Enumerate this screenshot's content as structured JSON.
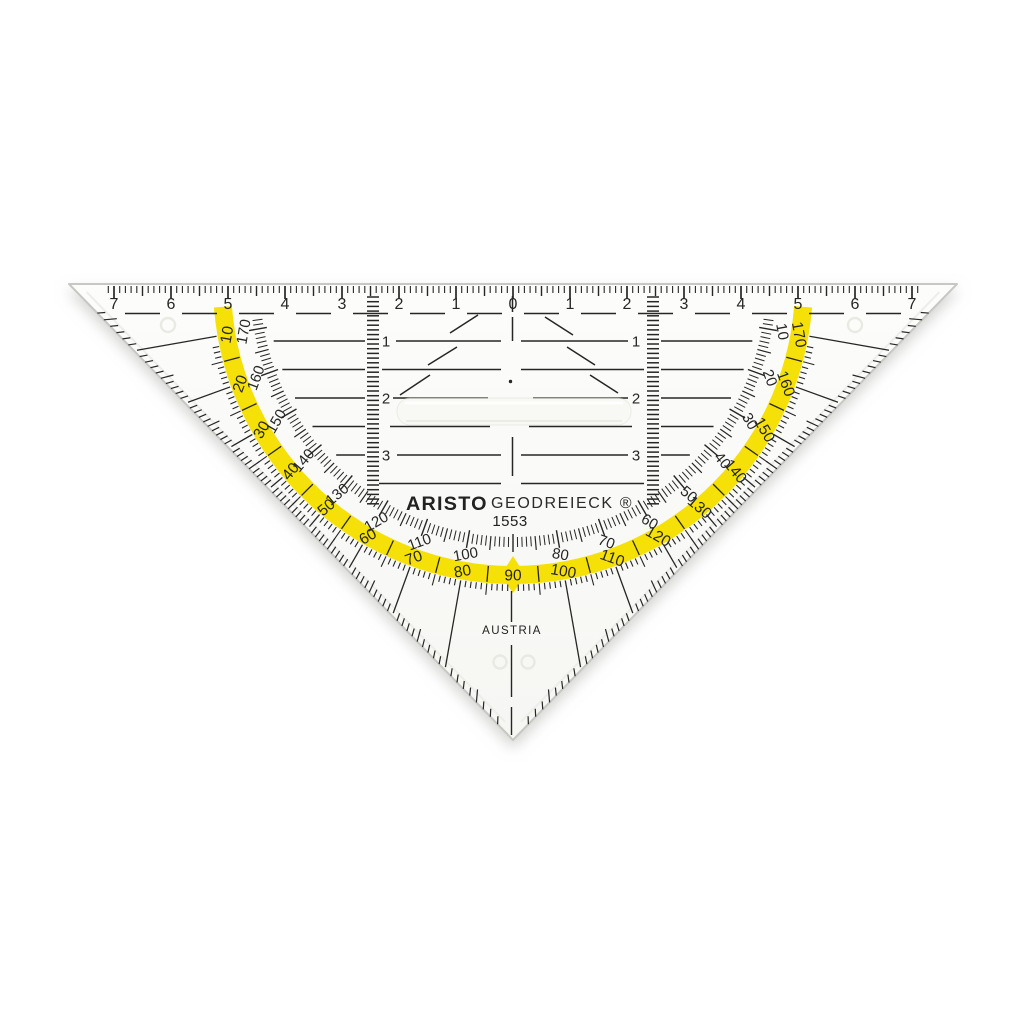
{
  "product": {
    "brand": "ARISTO",
    "name": "GEODREIECK ®",
    "model": "1553",
    "origin": "AUSTRIA"
  },
  "colors": {
    "background": "#ffffff",
    "body": "#fbfbf9",
    "ink": "#262624",
    "accent_yellow": "#F5E107",
    "shadow": "#a9a9a4"
  },
  "ruler_cm": {
    "left_labels": [
      "7",
      "6",
      "5",
      "4",
      "3",
      "2",
      "1"
    ],
    "center_label": "0",
    "right_labels": [
      "1",
      "2",
      "3",
      "4",
      "5",
      "6",
      "7"
    ]
  },
  "protractor": {
    "outer_scale_on_yellow_labels": [
      "10",
      "20",
      "30",
      "40",
      "50",
      "60",
      "70",
      "80",
      "90",
      "100",
      "110",
      "120",
      "130",
      "140",
      "150",
      "160",
      "170"
    ],
    "inner_scale_labels": [
      "170",
      "160",
      "150",
      "140",
      "130",
      "120",
      "110",
      "100",
      "80",
      "70",
      "60",
      "50",
      "40",
      "30",
      "20",
      "10"
    ]
  },
  "panel": {
    "row_labels": [
      "1",
      "2",
      "3"
    ]
  }
}
